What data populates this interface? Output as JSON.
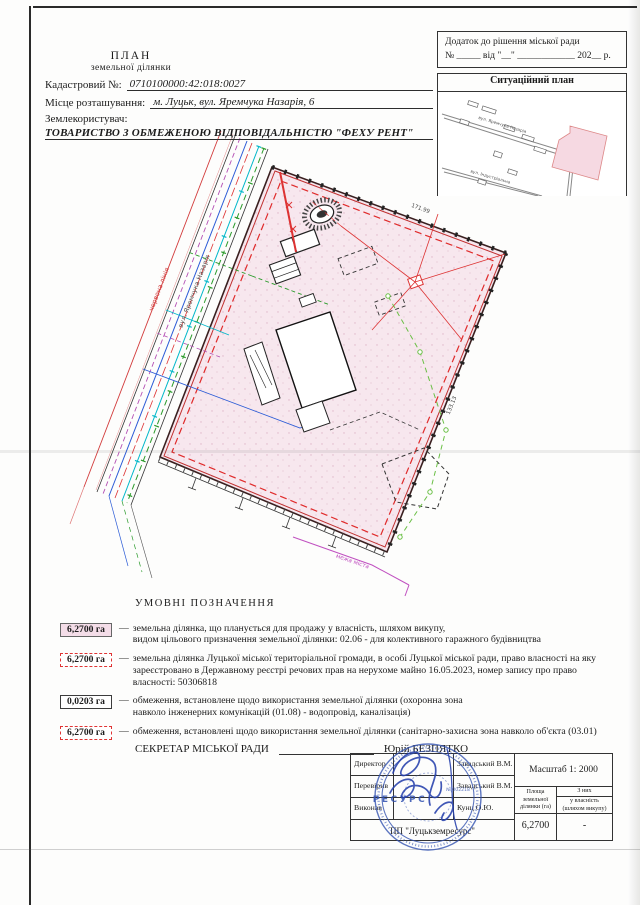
{
  "document": {
    "title_line1": "ПЛАН",
    "title_line2": "земельної ділянки",
    "cadastral_label": "Кадастровий №:",
    "cadastral_value": "0710100000:42:018:0027",
    "location_label": "Місце розташування:",
    "location_value": "м. Луцьк, вул. Яремчука Назарія, 6",
    "landuser_label": "Землекористувач:",
    "landuser_value": "ТОВАРИСТВО З ОБМЕЖЕНОЮ ВІДПОВІДАЛЬНІСТЮ \"ФЕХУ РЕНТ\""
  },
  "annex": {
    "line1": "Додаток до рішення  міської ради",
    "line2": "№ _____ від \"__\" ____________ 202__ р."
  },
  "situational": {
    "title": "Ситуаційний план",
    "street1": "вул. Яремчука Назарія",
    "street2": "вул. Індустріальна"
  },
  "plan": {
    "street_label": "вул. Яремчука Назарія",
    "red_line_label": "червона лінія",
    "city_boundary_label": "межа міста",
    "edge_label_top": "171.99",
    "edge_label_right": "133.13"
  },
  "legend": {
    "title": "УМОВНІ  ПОЗНАЧЕННЯ",
    "items": [
      {
        "value": "6,2700 га",
        "lines": [
          "земельна ділянка, що планується для продажу у власність, шляхом викупу,",
          "видом цільового призначення земельної ділянки: 02.06 - для колективного гаражного будівництва"
        ]
      },
      {
        "value": "6,2700 га",
        "lines": [
          "земельна ділянка Луцької міської територіальної громади, в особі Луцької міської ради, право власності на яку",
          "зареєстровано в Державному реєстрі речових прав на нерухоме майно 16.05.2023, номер запису про право",
          "власності: 50306818"
        ]
      },
      {
        "value": "0,0203 га",
        "lines": [
          "обмеження, встановлене щодо використання земельної ділянки (охоронна зона",
          "навколо інженерних комунікацій (01.08) - водопровід, каналізація)"
        ]
      },
      {
        "value": "6,2700 га",
        "lines": [
          "обмеження, встановлені щодо використання земельної ділянки (санітарно-захисна зона навколо об'єкта (03.01)"
        ]
      }
    ]
  },
  "secretary": {
    "label": "СЕКРЕТАР МІСЬКОЇ РАДИ",
    "name": "Юрій БЕЗПЯТКО"
  },
  "approval": {
    "rows": [
      {
        "role": "Директор",
        "name": "Завадський В.М."
      },
      {
        "role": "Перевірив",
        "name": "Завадський В.М."
      },
      {
        "role": "Виконав",
        "name": "Кунц О.Ю."
      }
    ],
    "company": "ПП \"Луцькземресурс\"",
    "scale": "Масштаб  1: 2000",
    "area_header_lines": [
      "Площа",
      "земельної",
      "ділянки (га)"
    ],
    "of_them": "З них",
    "buyout_lines": [
      "у власність",
      "(шляхом викупу)"
    ],
    "area_value": "6,2700",
    "buyout_value": "-",
    "seal_name": "РЕСУРС",
    "seal_number": "№ 002218"
  }
}
